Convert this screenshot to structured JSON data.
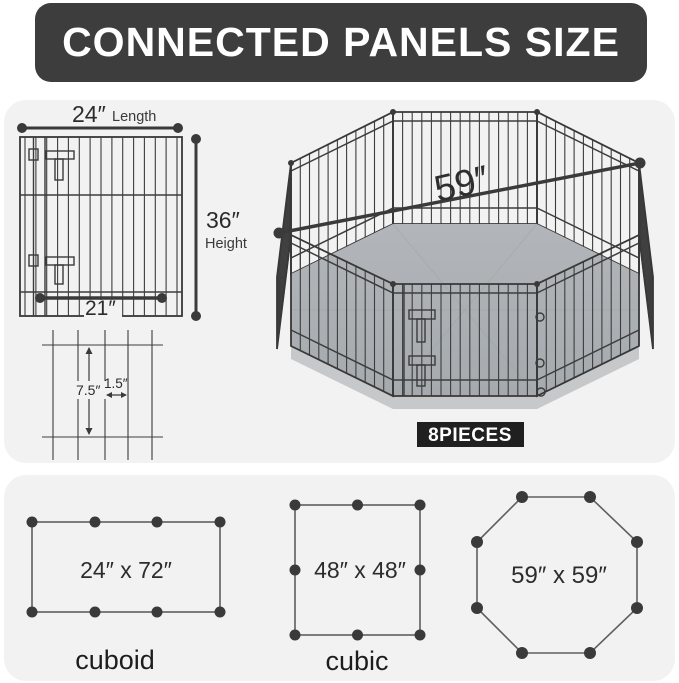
{
  "banner": {
    "title": "CONNECTED PANELS SIZE"
  },
  "panel": {
    "length_value": "24″",
    "length_label": "Length",
    "height_value": "36″",
    "height_label": "Height",
    "bottom_width": "21″",
    "wire_vertical_spacing": "7.5″",
    "wire_horizontal_spacing": "1.5″"
  },
  "playpen": {
    "diagonal": "59″",
    "pieces_badge": "8PIECES"
  },
  "configurations": [
    {
      "shape": "rectangle",
      "size": "24″ x 72″",
      "label": "cuboid"
    },
    {
      "shape": "square",
      "size": "48″ x 48″",
      "label": "cubic"
    },
    {
      "shape": "octagon",
      "size": "59″ x 59″",
      "label": ""
    }
  ],
  "colors": {
    "banner_bg": "#3d3d3d",
    "banner_text": "#ffffff",
    "section_bg": "#f2f2f2",
    "wire": "#3d3d3d",
    "floor": "#abb0b4",
    "floor_skirt": "#c6c8ca",
    "badge_bg": "#202020",
    "badge_text": "#ffffff",
    "text": "#2b2b2b"
  }
}
